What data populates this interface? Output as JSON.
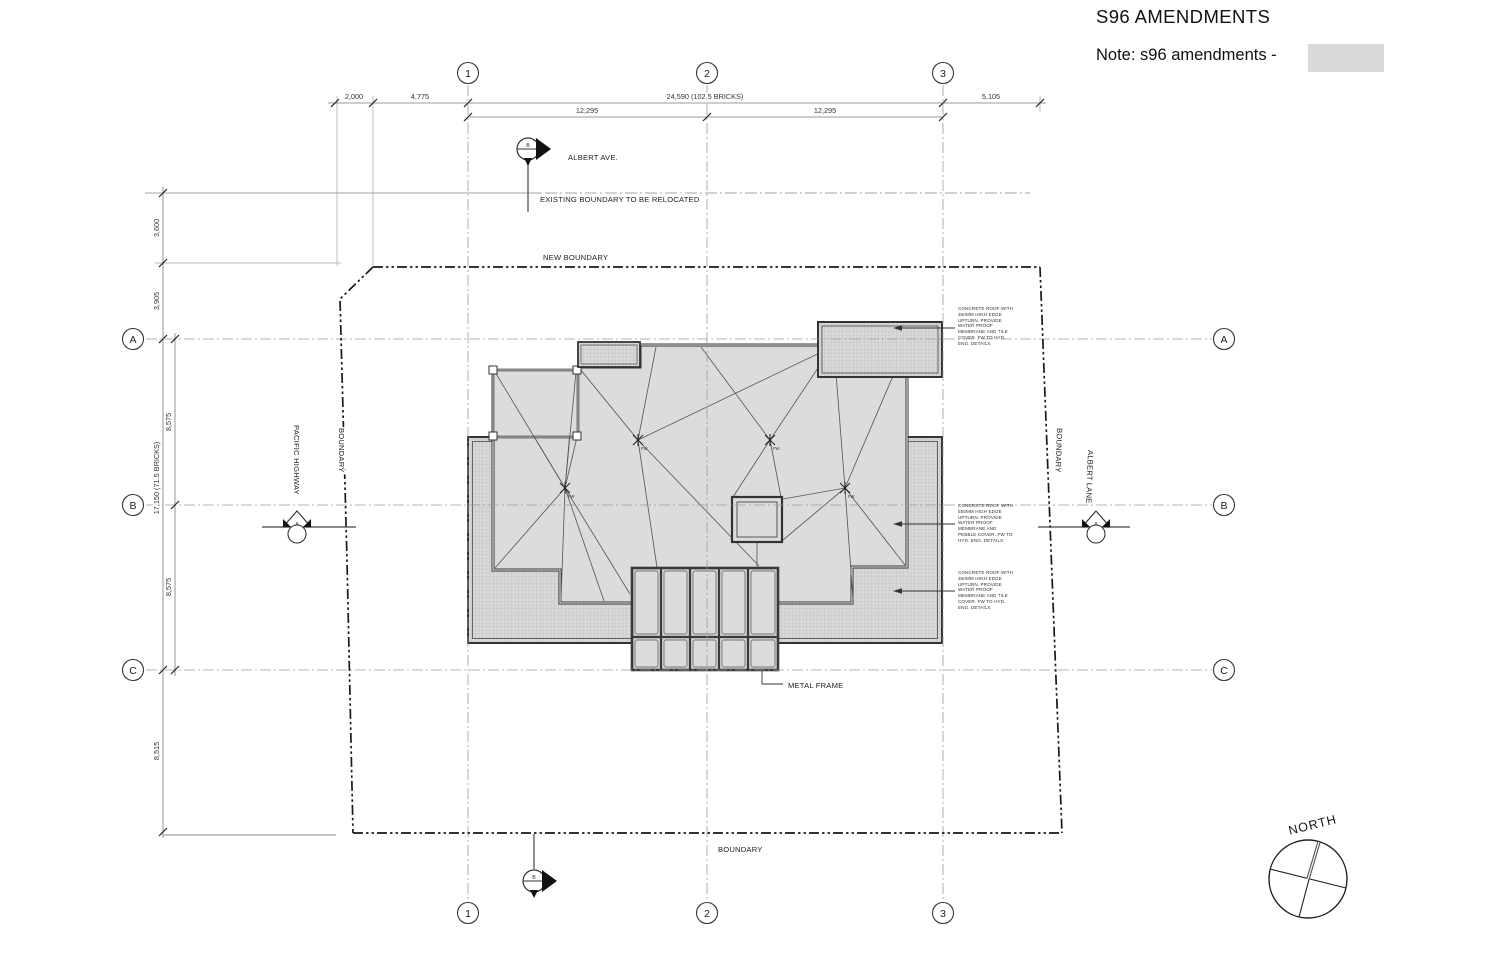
{
  "title": "S96 AMENDMENTS",
  "note": {
    "label": "Note: s96 amendments -",
    "swatch_color": "#d9d9d9"
  },
  "grid": {
    "columns": [
      "1",
      "2",
      "3"
    ],
    "rows": [
      "A",
      "B",
      "C"
    ]
  },
  "dimensions": {
    "top_outer": [
      "2,000",
      "4,775",
      "24,590 (102.5 BRICKS)",
      "5,105"
    ],
    "top_inner": [
      "12,295",
      "12,295"
    ],
    "left_outer": [
      "3,600",
      "3,905",
      "17,150 (71.5 BRICKS)",
      "8,515"
    ],
    "left_inner": [
      "8,575",
      "8,575"
    ]
  },
  "labels": {
    "street_top": "ALBERT AVE.",
    "existing_boundary": "EXISTING BOUNDARY TO BE RELOCATED",
    "new_boundary": "NEW BOUNDARY",
    "street_left": "PACIFIC HIGHWAY",
    "boundary_left": "BOUNDARY",
    "boundary_right": "BOUNDARY",
    "street_right": "ALBERT LANE",
    "boundary_bottom": "BOUNDARY",
    "metal_frame": "METAL FRAME",
    "north": "NORTH",
    "drain": "FW"
  },
  "section_markers": {
    "a": "A",
    "b": "B"
  },
  "annotations": {
    "roof_tile_top": "CONCRETE ROOF WITH\n300MM HIGH EDGE\nUPTURN. PROVIDE\nWATER PROOF\nMEMBRANE AND TILE\nCOVER. FW TO HYD.\nENG. DETAILS",
    "roof_pebble": "CONCRETE ROOF WITH\n500MM HIGH EDGE\nUPTURN. PROVIDE\nWATER PROOF\nMEMBRANE AND\nPEBBLE COVER. FW TO\nHYD. ENG. DETAILS",
    "roof_tile_bottom": "CONCRETE ROOF WITH\n300MM HIGH EDGE\nUPTURN. PROVIDE\nWATER PROOF\nMEMBRANE AND TILE\nCOVER. FW TO HYD.\nENG. DETAILS"
  },
  "colors": {
    "roof_fill": "#dcdcdc",
    "hatch_fill": "#d9d9d9",
    "line": "#333333"
  }
}
